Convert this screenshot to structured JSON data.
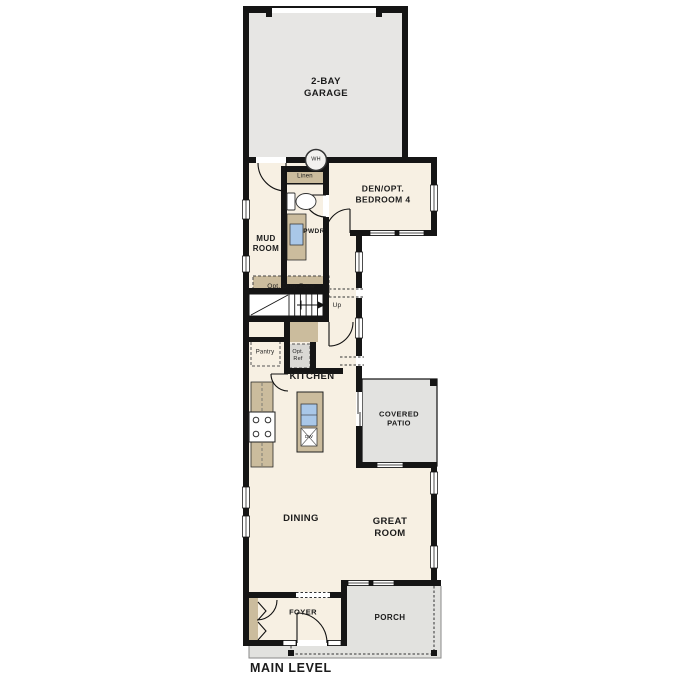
{
  "plan": {
    "title": "MAIN LEVEL",
    "rooms": {
      "garage": "2-BAY\nGARAGE",
      "den": "DEN/OPT.\nBEDROOM 4",
      "mud_room": "MUD\nROOM",
      "powder": "PWDR",
      "kitchen": "KITCHEN",
      "dining": "DINING",
      "great_room": "GREAT\nROOM",
      "foyer": "FOYER",
      "covered_patio": "COVERED\nPATIO",
      "porch": "PORCH"
    },
    "features": {
      "linen": "Linen",
      "opt_drop_zone": "Opt. Drop Zone",
      "stairs_up": "Up",
      "pantry": "Pantry",
      "opt_ref": "Opt.\nRef",
      "water_heater": "WH",
      "dishwasher": "DW"
    },
    "colors": {
      "wall": "#151515",
      "floor": "#f7f0e3",
      "concrete": "#e7e6e4",
      "porch": "#e2e2df",
      "cabinetry": "#cbbc9d",
      "sink": "#a9c7e8",
      "opt_ref_fill": "#d9d8d4"
    }
  }
}
